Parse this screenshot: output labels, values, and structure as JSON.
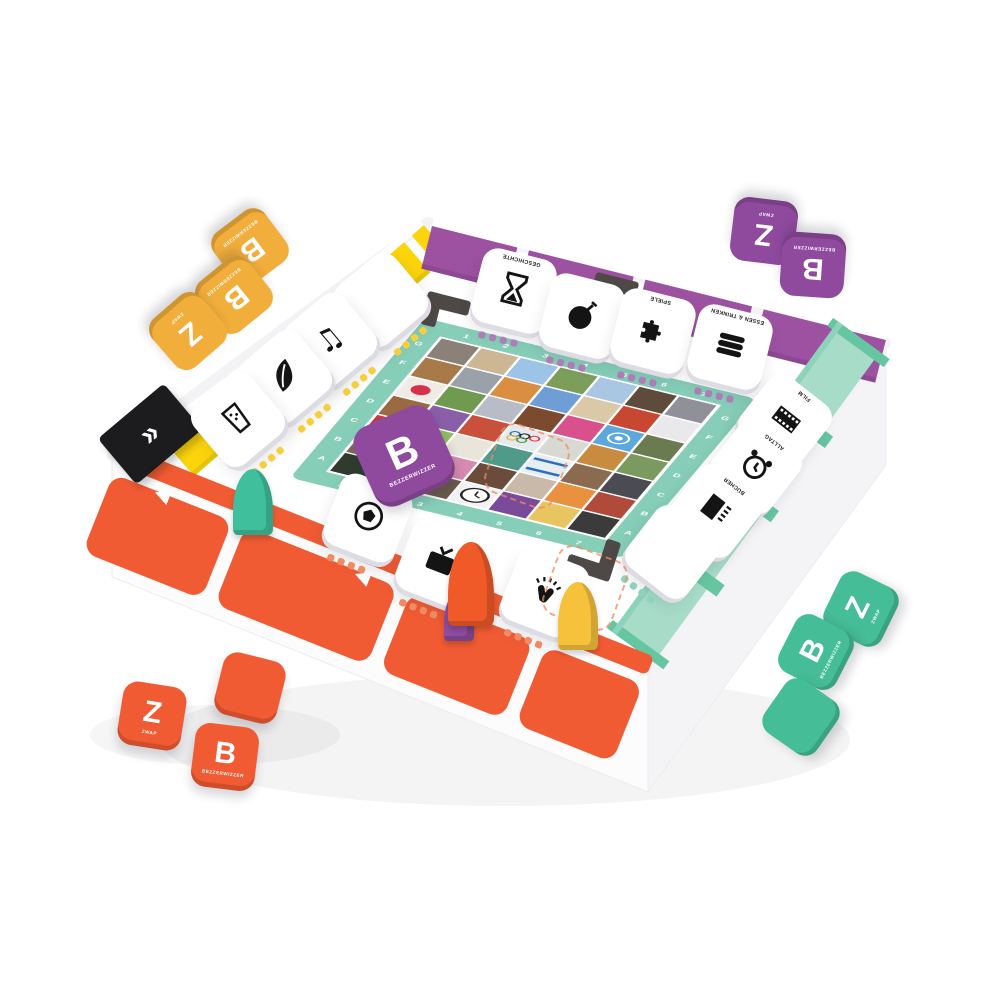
{
  "brand": {
    "name_label": "BEZZERWIZZER",
    "zwap_label": "ZWAP",
    "letter_b": "B",
    "letter_z": "Z"
  },
  "colors": {
    "yellow_wall": "#FBD40B",
    "purple_wall": "#9C51A1",
    "mint_wall": "#A7DCC8",
    "mint_divider": "#66C6A2",
    "orange_wall": "#F05B33",
    "board_frame": "#86CEB8",
    "tile_yellow": "#F2AE3B",
    "tile_purple": "#8F4A9E",
    "tile_orange": "#F05B33",
    "tile_green": "#45BD96",
    "bracket_gray": "#4E4946",
    "dot_purple": "#B07CB8",
    "dot_yellow": "#F7CE3E",
    "dot_mint": "#8ED2BC",
    "dot_orange": "#F08A63"
  },
  "extras": {
    "quote_mark": "»",
    "arrow_left": "◀"
  },
  "board": {
    "letters": [
      "A",
      "B",
      "C",
      "D",
      "E",
      "F",
      "G"
    ],
    "numbers": [
      "1",
      "2",
      "3",
      "4",
      "5",
      "6",
      "7"
    ],
    "mosaic": [
      [
        "#8b8178",
        "#cdb694",
        "#9dc4e6",
        "#7c9e5a",
        "#a9c6e2",
        "#5e4b3b",
        "#90909a"
      ],
      [
        "#a97a49",
        "#9aa1a9",
        "#d98e41",
        "#6f9ed6",
        "#d9c9a6",
        "#c84733",
        "#e9e9ec"
      ],
      [
        "#efece6",
        "#6f9a50",
        "#b8bcc6",
        "#7c4b2f",
        "#d8508c",
        "#5ba8dd",
        "#6b7b50"
      ],
      [
        "#9a6b40",
        "#8a5fa9",
        "#c9503b",
        "#e6e9ee",
        "#d9d9d3",
        "#c98b40",
        "#7a9a60"
      ],
      [
        "#c23b4b",
        "#8fbf60",
        "#e9e5da",
        "#509a8a",
        "#e6edf4",
        "#8a6b50",
        "#4b4b53"
      ],
      [
        "#7b6b5b",
        "#3b3b43",
        "#d88bb1",
        "#6b4b3b",
        "#c9b9a9",
        "#e89240",
        "#b04b3b"
      ],
      [
        "#2f3b2f",
        "#8b3b4b",
        "#6b5b4b",
        "#f2f2f4",
        "#7b4b9b",
        "#e8c560",
        "#3b3b3b"
      ]
    ],
    "special_cells": [
      {
        "row": 2,
        "col": 0,
        "type": "japan-flag"
      },
      {
        "row": 2,
        "col": 5,
        "type": "un-emblem"
      },
      {
        "row": 3,
        "col": 3,
        "type": "olympic-rings"
      },
      {
        "row": 4,
        "col": 4,
        "type": "flag-stripe"
      },
      {
        "row": 6,
        "col": 3,
        "type": "clock-face"
      }
    ]
  },
  "category_tiles": [
    {
      "icon": "hourglass-icon",
      "label": "GESCHICHTE",
      "side": "purple"
    },
    {
      "icon": "bomb-icon",
      "label": "",
      "side": "purple"
    },
    {
      "icon": "puzzle-icon",
      "label": "SPIELE",
      "side": "purple"
    },
    {
      "icon": "sandwich-icon",
      "label": "ESSEN & TRINKEN",
      "side": "purple"
    },
    {
      "icon": "",
      "label": "",
      "side": "yellow"
    },
    {
      "icon": "music-note-icon",
      "label": "",
      "side": "yellow"
    },
    {
      "icon": "leaf-icon",
      "label": "",
      "side": "yellow"
    },
    {
      "icon": "drink-glass-icon",
      "label": "",
      "side": "yellow"
    },
    {
      "icon": "film-strip-icon",
      "label": "FILM",
      "side": "mint"
    },
    {
      "icon": "alarm-clock-icon",
      "label": "ALLTAG",
      "side": "mint"
    },
    {
      "icon": "book-icon",
      "label": "BÜCHER",
      "side": "mint"
    },
    {
      "icon": "",
      "label": "",
      "side": "mint"
    },
    {
      "icon": "soccer-ball-icon",
      "label": "",
      "side": "orange"
    },
    {
      "icon": "tv-icon",
      "label": "",
      "side": "orange"
    },
    {
      "icon": "clapping-hands-icon",
      "label": "",
      "side": "orange"
    }
  ],
  "scattered_tiles": [
    {
      "color": "yellow",
      "letter": "B",
      "sub": "BEZZERWIZZER"
    },
    {
      "color": "yellow",
      "letter": "B",
      "sub": "BEZZERWIZZER"
    },
    {
      "color": "yellow",
      "letter": "Z",
      "sub": "ZWAP"
    },
    {
      "color": "purple",
      "letter": "Z",
      "sub": "ZWAP"
    },
    {
      "color": "purple",
      "letter": "B",
      "sub": "BEZZERWIZZER"
    },
    {
      "color": "purple",
      "letter": "B",
      "sub": "BEZZERWIZZER"
    },
    {
      "color": "orange",
      "letter": "Z",
      "sub": "ZWAP"
    },
    {
      "color": "orange",
      "letter": "",
      "sub": ""
    },
    {
      "color": "orange",
      "letter": "B",
      "sub": "BEZZERWIZZER"
    },
    {
      "color": "green",
      "letter": "Z",
      "sub": "ZWAP"
    },
    {
      "color": "green",
      "letter": "B",
      "sub": "BEZZERWIZZER"
    },
    {
      "color": "green",
      "letter": "",
      "sub": ""
    }
  ],
  "pawns": [
    {
      "name": "green",
      "color": "#3FBF9B"
    },
    {
      "name": "purple",
      "color": "#8E4D9E"
    },
    {
      "name": "orange",
      "color": "#F05A28"
    },
    {
      "name": "yellow",
      "color": "#F6C23C"
    }
  ]
}
